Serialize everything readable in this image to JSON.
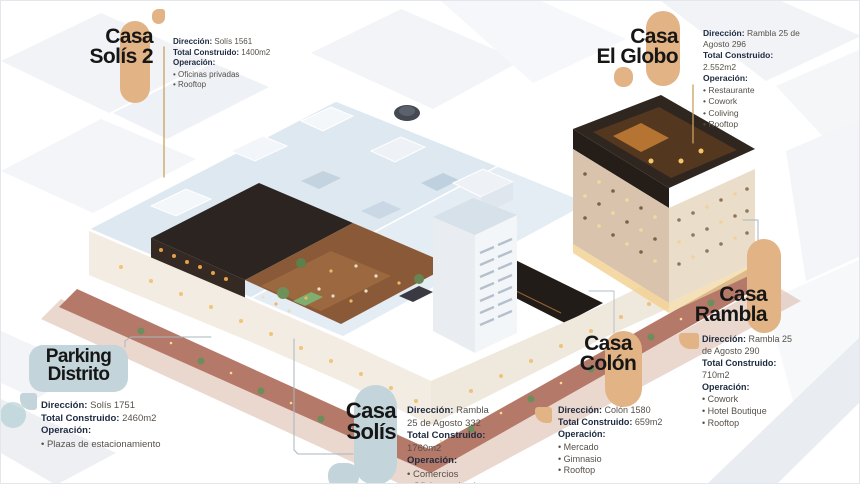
{
  "colors": {
    "accent_tan": "#E2B384",
    "accent_bluegray": "#C3D5DA",
    "title_text": "#161616",
    "label_text": "#1D2A3F",
    "value_text": "#56504A"
  },
  "labels": {
    "direccion": "Dirección:",
    "total": "Total Construido:",
    "operacion": "Operación:"
  },
  "callouts": {
    "solis2": {
      "title_line1": "Casa",
      "title_line2": "Solís 2",
      "direccion": "Solís 1561",
      "total": "1400m2",
      "items": [
        "Oficinas privadas",
        "Rooftop"
      ]
    },
    "el_globo": {
      "title_line1": "Casa",
      "title_line2": "El Globo",
      "direccion": "Rambla 25 de Agosto 296",
      "total": "2.552m2",
      "items": [
        "Restaurante",
        "Cowork",
        "Coliving",
        "Rooftop"
      ]
    },
    "rambla": {
      "title_line1": "Casa",
      "title_line2": "Rambla",
      "direccion": "Rambla 25 de Agosto 290",
      "total": "710m2",
      "items": [
        "Cowork",
        "Hotel Boutique",
        "Rooftop"
      ]
    },
    "colon": {
      "title_line1": "Casa",
      "title_line2": "Colón",
      "direccion": "Colón 1580",
      "total": "659m2",
      "items": [
        "Mercado",
        "Gimnasio",
        "Rooftop"
      ]
    },
    "solis": {
      "title_line1": "Casa",
      "title_line2": "Solís",
      "direccion": "Rambla 25 de Agosto 332",
      "total": "1760m2",
      "items": [
        "Comercios",
        "Oficinas privadas",
        "Rooftop"
      ]
    },
    "parking": {
      "title_line1": "Parking",
      "title_line2": "Distrito",
      "direccion": "Solís 1751",
      "total": "2460m2",
      "items": [
        "Plazas de estacionamiento"
      ]
    }
  }
}
